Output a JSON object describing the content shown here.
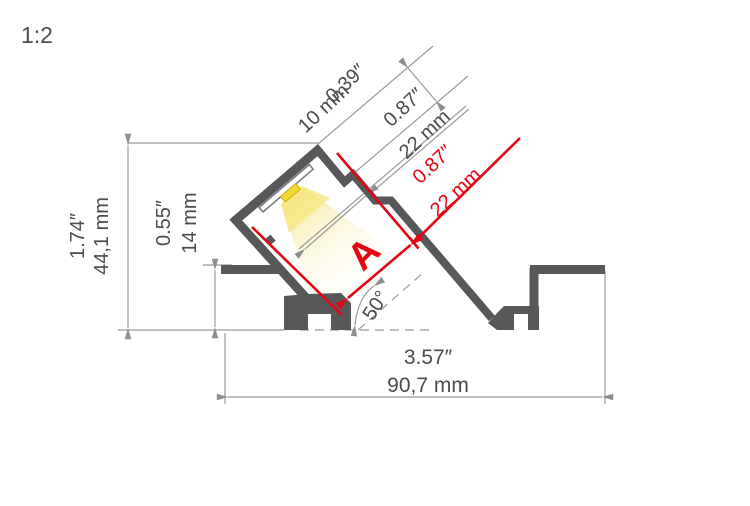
{
  "drawing": {
    "scale_label": "1:2"
  },
  "colors": {
    "profile": "#58585a",
    "dim_line": "#9b9b9d",
    "arrow": "#8e8e90",
    "dim_text": "#4c4c4e",
    "red": "#e30613",
    "led_fill": "#f2d832",
    "led_stroke": "#c9af10",
    "plate_stroke": "#77777a"
  },
  "dimensions": {
    "slot_depth": {
      "inches": "0.39″",
      "mm": "10 mm"
    },
    "channel_width": {
      "inches": "0.87″",
      "mm": "22 mm"
    },
    "light_opening": {
      "inches": "0.87″",
      "mm": "22 mm",
      "label": "A"
    },
    "overall_height": {
      "inches": "1.74″",
      "mm": "44,1 mm"
    },
    "recess_depth": {
      "inches": "0.55″",
      "mm": "14 mm"
    },
    "overall_width": {
      "inches": "3.57″",
      "mm": "90,7 mm"
    },
    "beam_angle": "50°"
  }
}
